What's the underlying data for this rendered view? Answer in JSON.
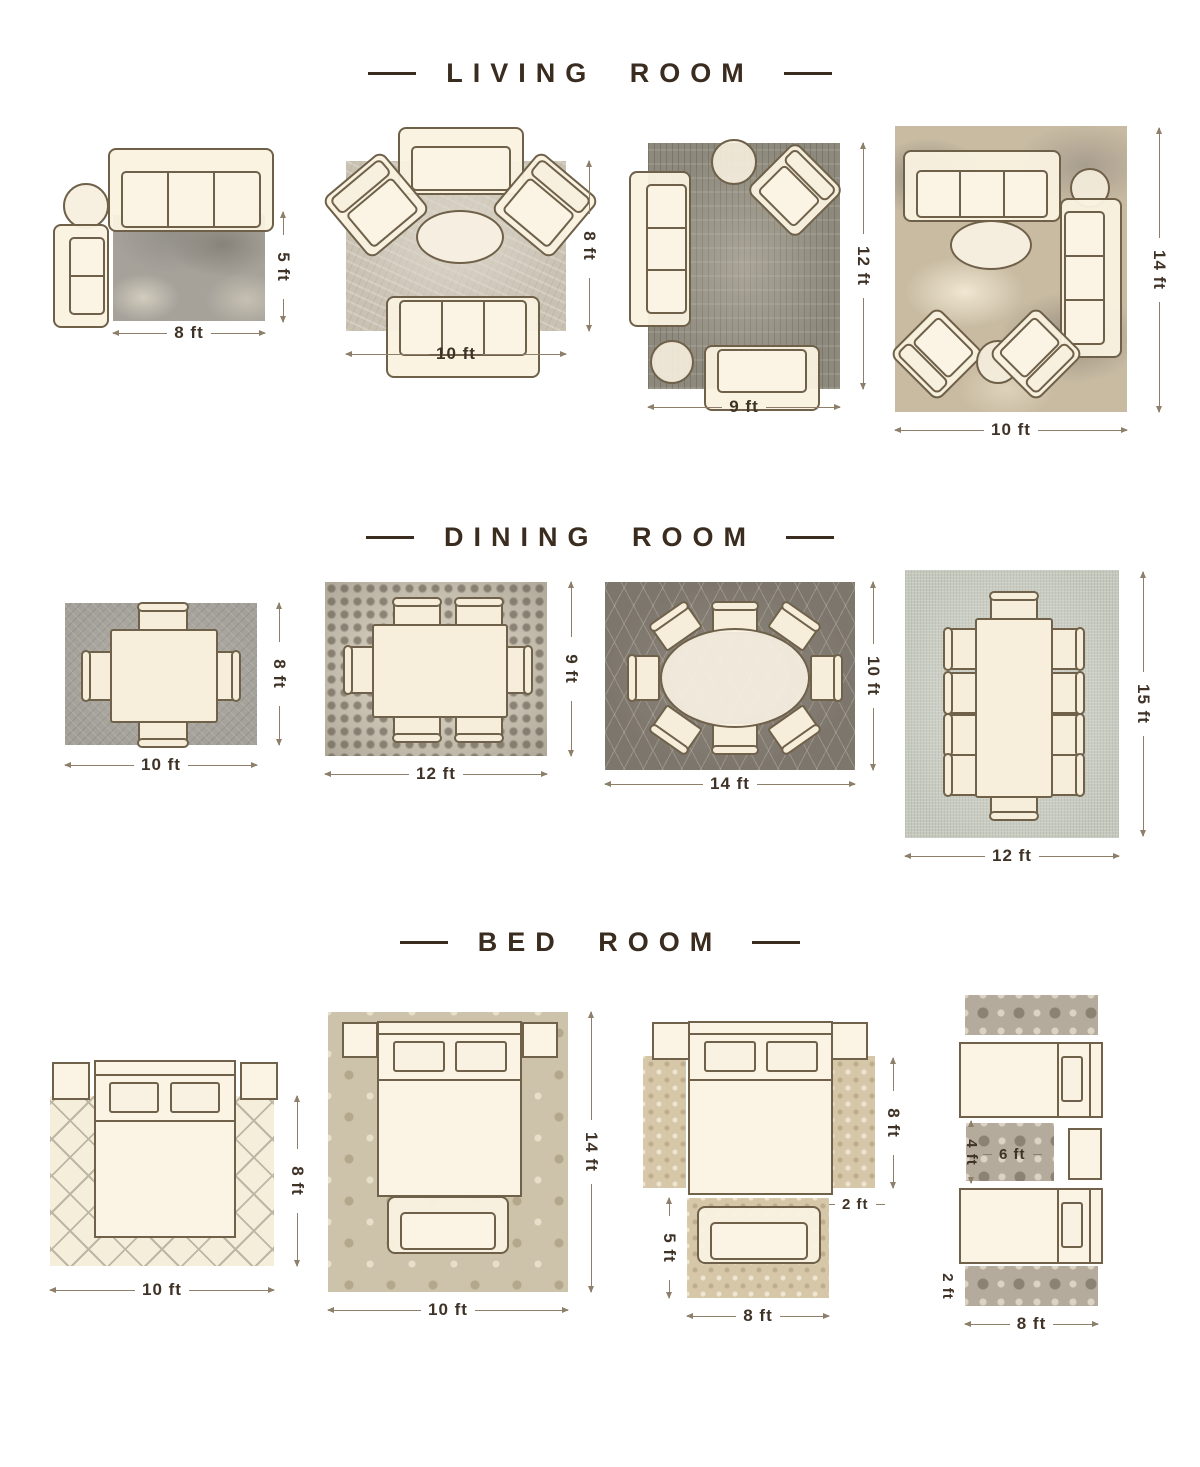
{
  "colors": {
    "title": "#3a2c1e",
    "dimension_text": "#3f3226",
    "dimension_line": "#8d7f6a",
    "furniture_fill": "#faf2e0",
    "furniture_border": "#6f6149"
  },
  "sections": {
    "living_room": {
      "title": "LIVING ROOM",
      "layouts": [
        {
          "rug_size": "8 ft x 5 ft",
          "width_label": "8 ft",
          "height_label": "5 ft",
          "furniture": [
            "three-seat-sofa",
            "round-side-table",
            "two-seat-sofa"
          ]
        },
        {
          "rug_size": "10 ft x 8 ft",
          "width_label": "10 ft",
          "height_label": "8 ft",
          "furniture": [
            "loveseat",
            "accent-chair",
            "accent-chair",
            "oval-coffee-table",
            "three-seat-sofa"
          ]
        },
        {
          "rug_size": "9 ft x 12 ft",
          "width_label": "9 ft",
          "height_label": "12 ft",
          "furniture": [
            "three-seat-sofa",
            "round-side-table",
            "accent-chair",
            "round-side-table",
            "loveseat"
          ]
        },
        {
          "rug_size": "10 ft x 14 ft",
          "width_label": "10 ft",
          "height_label": "14 ft",
          "furniture": [
            "three-seat-sofa",
            "round-side-table",
            "three-seat-sofa",
            "oval-coffee-table",
            "accent-chair",
            "accent-chair",
            "round-side-table"
          ]
        }
      ]
    },
    "dining_room": {
      "title": "DINING ROOM",
      "layouts": [
        {
          "rug_size": "10 ft x 8 ft",
          "width_label": "10 ft",
          "height_label": "8 ft",
          "chairs": 4
        },
        {
          "rug_size": "12 ft x 9 ft",
          "width_label": "12 ft",
          "height_label": "9 ft",
          "chairs": 6
        },
        {
          "rug_size": "14 ft x 10 ft",
          "width_label": "14 ft",
          "height_label": "10 ft",
          "chairs": 8
        },
        {
          "rug_size": "12 ft x 15 ft",
          "width_label": "12 ft",
          "height_label": "15 ft",
          "chairs": 10
        }
      ]
    },
    "bed_room": {
      "title": "BED ROOM",
      "layouts": [
        {
          "rug_size": "10 ft x 8 ft",
          "width_label": "10 ft",
          "height_label": "8 ft",
          "furniture": [
            "nightstand",
            "queen-bed",
            "nightstand"
          ]
        },
        {
          "rug_size": "10 ft x 14 ft",
          "width_label": "10 ft",
          "height_label": "14 ft",
          "furniture": [
            "nightstand",
            "queen-bed",
            "nightstand",
            "bench"
          ]
        },
        {
          "runner_length_label": "8 ft",
          "runner_width_label": "2 ft",
          "foot_rug_height_label": "5 ft",
          "foot_rug_width_label": "8 ft",
          "furniture": [
            "nightstand",
            "queen-bed",
            "nightstand",
            "side-runner",
            "side-runner",
            "bench"
          ]
        },
        {
          "between_rug_height_label": "4 ft",
          "between_rug_width_label": "6 ft",
          "runner_width_label": "2 ft",
          "runner_length_label": "8 ft",
          "furniture": [
            "runner",
            "twin-bed",
            "between-rug",
            "nightstand",
            "twin-bed",
            "runner"
          ]
        }
      ]
    }
  }
}
